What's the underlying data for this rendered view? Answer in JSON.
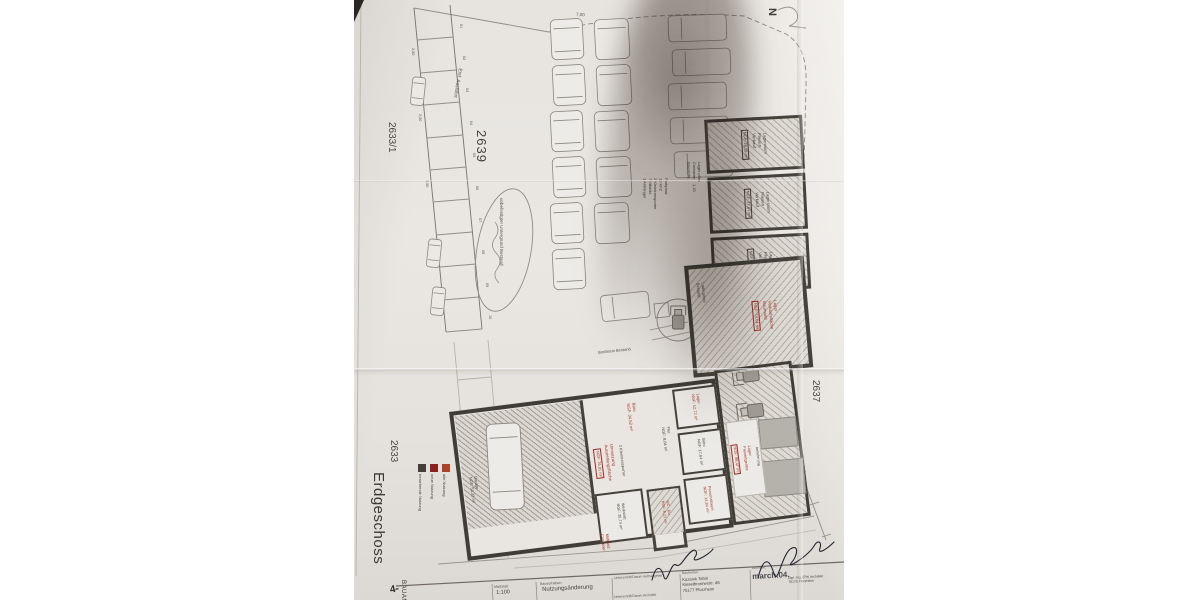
{
  "photo": {
    "floor_label": "Erdgeschoss",
    "north_label": "N",
    "page_number": "4-",
    "side_label": "BAUANTRAG",
    "parcels": {
      "left_upper": "2633/1",
      "left_lower": "2633",
      "main": "2639",
      "right": "2637",
      "bottom": "2601",
      "bottom_right": "2601/1"
    },
    "site": {
      "entrance": "Einf. Ausfahrt",
      "ground_note": "unbefestigter Untergrund Bestand",
      "curb_note": "Bordstein Bestand",
      "dim_top": "7,00",
      "dim_stall": "2,50",
      "dim_small": "1,20",
      "stalls": [
        "01",
        "02",
        "03",
        "04",
        "05",
        "06",
        "07",
        "08",
        "09",
        "10"
      ],
      "parking_info": "Parkplatz\n13 KFZ\n2 Kleintransporter\n7 Mittelkl.\n1 Anhänger",
      "open_storage": "Lager offen\nContainer\nBaustoffe"
    },
    "legend": [
      {
        "color": "#43403b",
        "label": "bestehende Nutzung"
      },
      {
        "color": "#8a211d",
        "label": "neue Nutzung"
      },
      {
        "color": "#a8432c",
        "label": "alte Nutzung"
      }
    ],
    "storage_rooms": [
      {
        "lines": "Lagerraum\nFliesen\nVerkauf",
        "area": "NGF: 26,18 m²"
      },
      {
        "lines": "Lagerraum\nFliesen\nVerkauf",
        "area": "NGF: 27,87 m²"
      },
      {
        "lines": "Lagerraum\nFliesen\nVerkauf",
        "area": "NGF: 34,58 m²"
      }
    ],
    "sales_room": {
      "lines": "Lager\nVerkaufsfläche\nBaumarkt",
      "area": "NGF: 74,64 m²",
      "side_note": "Laderampe\nBestand"
    },
    "ground_floor": {
      "garage": "Garage\nNGF: 54,32 m²",
      "conversion_lines": "Umnutzung\nAusstellungsfläche",
      "conversion_area": "NGF: 76,91 m²",
      "conversion_note": "2 Kleintransporter",
      "office_front": "Büro\nNGF: 34,52 m²",
      "hall": "Flur\nNGF: 8,04 m²",
      "storage_small": "Lager\nNGF: 12,72 m²",
      "office_back": "Büro\nNGF: 17,64 m²",
      "staff": "Personalraum\nNGF: 14,84 m²",
      "workshop": "Werkstatt\nNGF: 35,74 m²",
      "wc": "WC · Du\nNGF: 6,21 m²",
      "leisure_lines": "Lager\nFreizeitgeräte",
      "leisure_area": "NGF: 88,47 m²",
      "leisure_note": "Anlieferung",
      "waste": "Müllplatz\nContainer"
    },
    "titleblock": {
      "scale_header": "Maßstab:",
      "scale": "1:100",
      "project_header": "Bauvorhaben:",
      "project": "Nutzungsänderung",
      "sign_client_header": "Unterschrift/Datum Auftraggeber",
      "sign_architect_header": "Unterschrift/Datum Architekt",
      "client_header": "Bauherren:",
      "client": "Kazanik Tahiri\nKieselbronnerstr. 48\n75177 Pforzheim",
      "architect_header": "Architekt:",
      "architect_logo": "march.04.",
      "architect": "Dipl. Ing. (FH) Architekt\n75175 Pforzheim"
    }
  }
}
